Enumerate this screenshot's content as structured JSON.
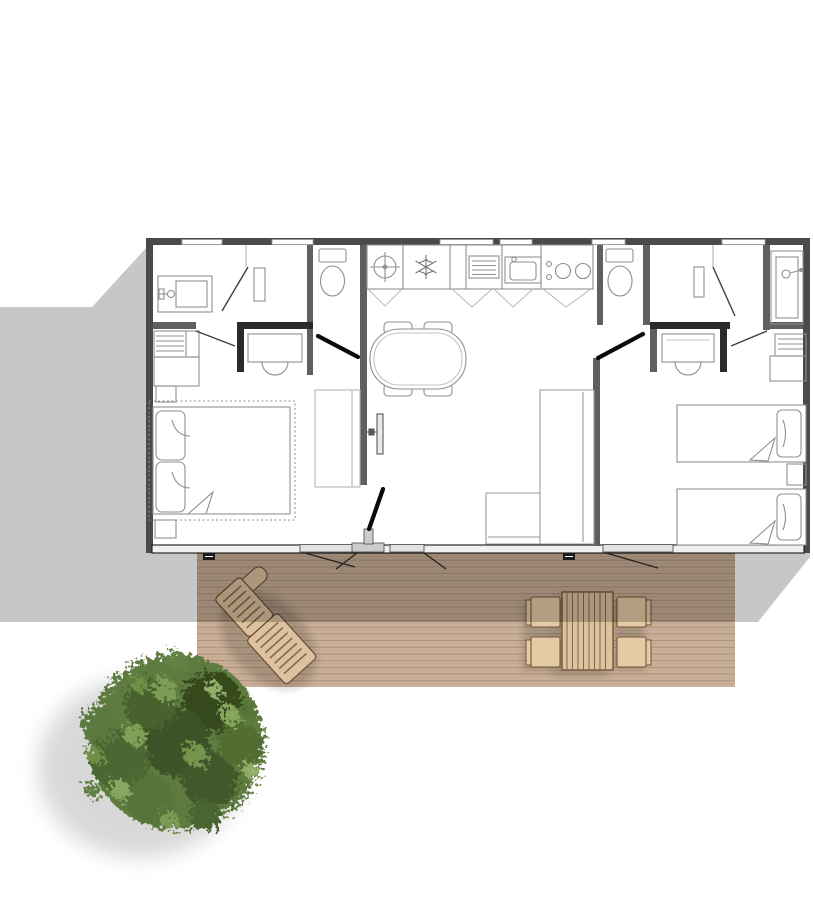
{
  "scene": {
    "kind": "mobile-home floor plan, top view, with wooden deck, outdoor furniture and tree",
    "building": {
      "rooms": [
        {
          "name": "bathroom-left",
          "fixtures": [
            "washbasin",
            "cabinet",
            "door"
          ]
        },
        {
          "name": "wc-left",
          "fixtures": [
            "toilet",
            "door"
          ]
        },
        {
          "name": "master-bedroom",
          "fixtures": [
            "double-bed",
            "pillows",
            "wardrobe-shelves",
            "nightstands",
            "vanity-desk-with-basin",
            "storage-cabinet"
          ]
        },
        {
          "name": "kitchen",
          "fixtures": [
            "water-heater",
            "fridge",
            "drainer",
            "sink",
            "hob-2-burners",
            "base-cabinets"
          ]
        },
        {
          "name": "living-dining",
          "fixtures": [
            "dining-table-4-seats",
            "tv",
            "corner-sofa"
          ]
        },
        {
          "name": "wc-right",
          "fixtures": [
            "toilet",
            "door"
          ]
        },
        {
          "name": "bathroom-right",
          "fixtures": [
            "shower-basin",
            "cabinet",
            "door"
          ]
        },
        {
          "name": "twin-bedroom",
          "fixtures": [
            "single-bed",
            "single-bed",
            "nightstand",
            "wardrobe-shelves",
            "vanity-desk-with-basin"
          ]
        }
      ],
      "windows_top_wall": 6,
      "deck_doors": 3
    },
    "outdoor": {
      "deck": "wooden terrace with horizontal planks",
      "furniture": [
        "sun-lounger",
        "patio-table",
        "patio-chair",
        "patio-chair",
        "patio-chair",
        "patio-chair"
      ],
      "vegetation": "round tree canopy, top view",
      "shadow": "building shadow cast to lower-left"
    }
  },
  "colors": {
    "background": "#ffffff",
    "wall_exterior": "#4a4a4a",
    "wall_interior": "#5f5f5f",
    "wall_dark": "#2b2b2b",
    "floor": "#ffffff",
    "fixture_line": "#8f8f8f",
    "light_line": "#b5b5b5",
    "door_leaf": "#0a0a0a",
    "shadow": "rgba(0,0,0,0.22)",
    "deck_wood": "#cab098",
    "deck_plank_line": "rgba(90,60,40,0.28)",
    "furniture_wood": "#dcc29e",
    "furniture_wood_alt": "#e4cba6",
    "furniture_outline": "#6b4e31",
    "tree_base": "#5e7c40",
    "tree_dark": "#35491f",
    "tree_light": "#86a65c"
  }
}
